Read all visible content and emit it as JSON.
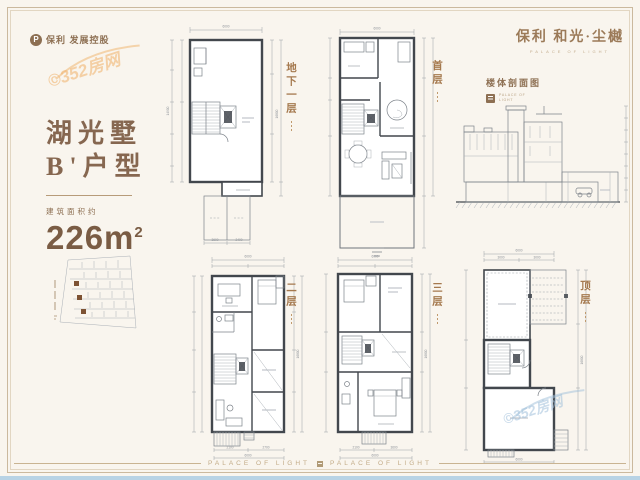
{
  "brand": {
    "left_logo_mark": "P",
    "left_logo_text": "保利 发展控股",
    "right_logo_title": "保利 和光·尘樾",
    "right_logo_subtitle": "PALACE OF LIGHT"
  },
  "info": {
    "villa_name": "湖光墅",
    "unit_type": "B'户型",
    "area_label": "建筑面积约",
    "area_value": "226m",
    "area_superscript": "2"
  },
  "floors": {
    "basement": "地下一层",
    "first": "首层",
    "second": "二层",
    "third": "三层",
    "top": "顶层"
  },
  "section_view": {
    "title": "楼体剖面图",
    "logo_caption_line1": "PALACE OF",
    "logo_caption_line2": "LIGHT"
  },
  "dims": {
    "d6000": "6000",
    "d3600": "3600",
    "d2400": "2400",
    "d3000": "3000",
    "d2100": "2100",
    "d2700": "2700",
    "d14900": "14900",
    "d16800": "16800"
  },
  "footer": {
    "left_text": "PALACE OF LIGHT",
    "right_text": "PALACE OF LIGHT"
  },
  "watermark": {
    "text": "©352房网"
  },
  "colors": {
    "background": "#f9f5ee",
    "frame": "#cbb99e",
    "brand_brown": "#8d6f52",
    "floor_label_orange": "#a5794e",
    "wall": "#42474d",
    "footer_gold": "#c2ab87",
    "bottom_bar_blue": "#b8d3e5",
    "watermark_orange": "#f0b673",
    "watermark_blue": "#a0c0da"
  }
}
